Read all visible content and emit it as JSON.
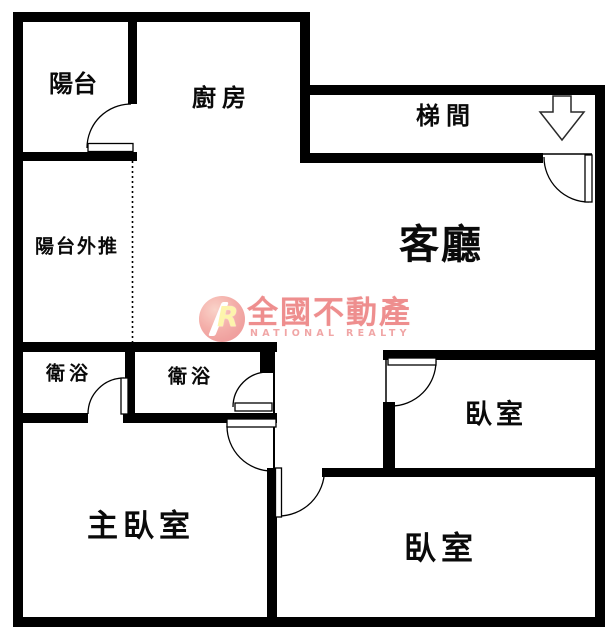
{
  "floorplan": {
    "rooms": {
      "balcony": {
        "label": "陽台"
      },
      "kitchen": {
        "label": "廚房"
      },
      "stairwell": {
        "label": "梯間"
      },
      "living_room": {
        "label": "客廳"
      },
      "balcony_extension": {
        "label": "陽台外推"
      },
      "bathroom_1": {
        "label": "衛浴"
      },
      "bathroom_2": {
        "label": "衛浴"
      },
      "bedroom_right": {
        "label": "臥室"
      },
      "master_bedroom": {
        "label": "主臥室"
      },
      "bedroom_bottom": {
        "label": "臥室"
      }
    },
    "watermark": {
      "logo_letter": "R",
      "brand": "全國不動產",
      "subtitle": "NATIONAL REALTY",
      "brand_color": "#ec7f7f"
    },
    "colors": {
      "wall": "#000000",
      "background": "#ffffff"
    }
  }
}
